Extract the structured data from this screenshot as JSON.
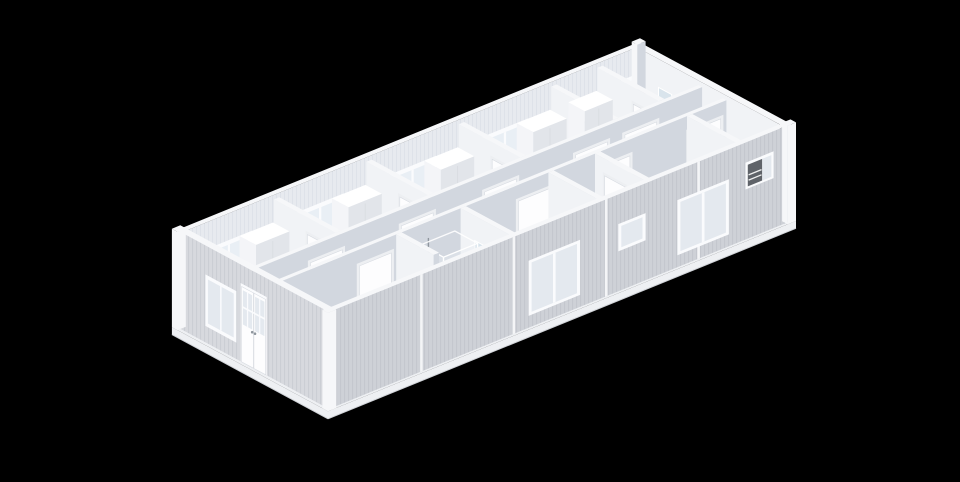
{
  "meta": {
    "kind": "isometric-3d-floorplan-render",
    "subject": "single-storey modular container building, roof removed, viewed from above at an angle",
    "background": "solid black, no text or UI controls visible"
  },
  "scene": {
    "building": {
      "modules": 5,
      "zones": [
        "back row of rooms with windows and wardrobes",
        "central corridor running the full length",
        "front row with bedroom, bathrooms and rooms"
      ]
    },
    "objects": [
      {
        "name": "back-wall-window",
        "count": 5
      },
      {
        "name": "wardrobe",
        "count": 5
      },
      {
        "name": "partition-door",
        "count": 4
      },
      {
        "name": "corridor-door",
        "count": 5
      },
      {
        "name": "room-door",
        "count": 4
      },
      {
        "name": "entrance-glazed-double-door",
        "count": 1
      },
      {
        "name": "end-wall-window",
        "count": 1
      },
      {
        "name": "front-window-large",
        "count": 2
      },
      {
        "name": "front-window-small",
        "count": 1
      },
      {
        "name": "front-window-with-ac-unit",
        "count": 1
      },
      {
        "name": "bed-with-wooden-frame",
        "count": 1
      },
      {
        "name": "pillow",
        "count": 2
      },
      {
        "name": "duvet",
        "count": 1
      },
      {
        "name": "shower-enclosure",
        "count": 1
      },
      {
        "name": "toilet",
        "count": 2
      },
      {
        "name": "washbasin",
        "count": 3
      },
      {
        "name": "mirror",
        "count": 3
      },
      {
        "name": "water-heater",
        "count": 1
      },
      {
        "name": "ac-unit",
        "count": 1
      }
    ]
  },
  "colors": {
    "bg": "#000000",
    "wall_top": "#f6f7f9",
    "ext_end": "#d7d9de",
    "ext_front": "#ced1d7",
    "int_back": "#e7eaef",
    "int_se": "#d2d7df",
    "int_west": "#f1f3f6",
    "floor_room": "#dde2e8",
    "floor_corridor": "#e7e9ed",
    "floor_front": "#e3e6ea",
    "floor_bedroom": "#d8e1dd",
    "floor_bath": "#ccdae2",
    "window_frame": "#fafbfd",
    "glass": "#e9eff5",
    "glass_ext": "#e4e9ef",
    "door_frame": "#edeff2",
    "door_leaf": "#fdfdfe",
    "wood": "#d59c63",
    "wood_dark": "#b9804a",
    "wood_top": "#e5b37e",
    "bedding": "#f6f7f5",
    "bedding_shadow": "#e4e6e3",
    "pillow": "#fcfcfb",
    "fixture": "#fbfcfd",
    "fixture_shadow": "#d8dde3",
    "fixture_top": "#ffffff",
    "metal": "#8f969e",
    "heater": "#e7eaee",
    "heater_shadow": "#c6cbd2",
    "ac_unit": "#5f6369",
    "mirror": "#d9e4ec",
    "skirt": "#eef0f3",
    "skirt_shadow": "#d0d3d8",
    "wardrobe_w": "#f4f5f8",
    "wardrobe_s": "#e2e5ea"
  }
}
